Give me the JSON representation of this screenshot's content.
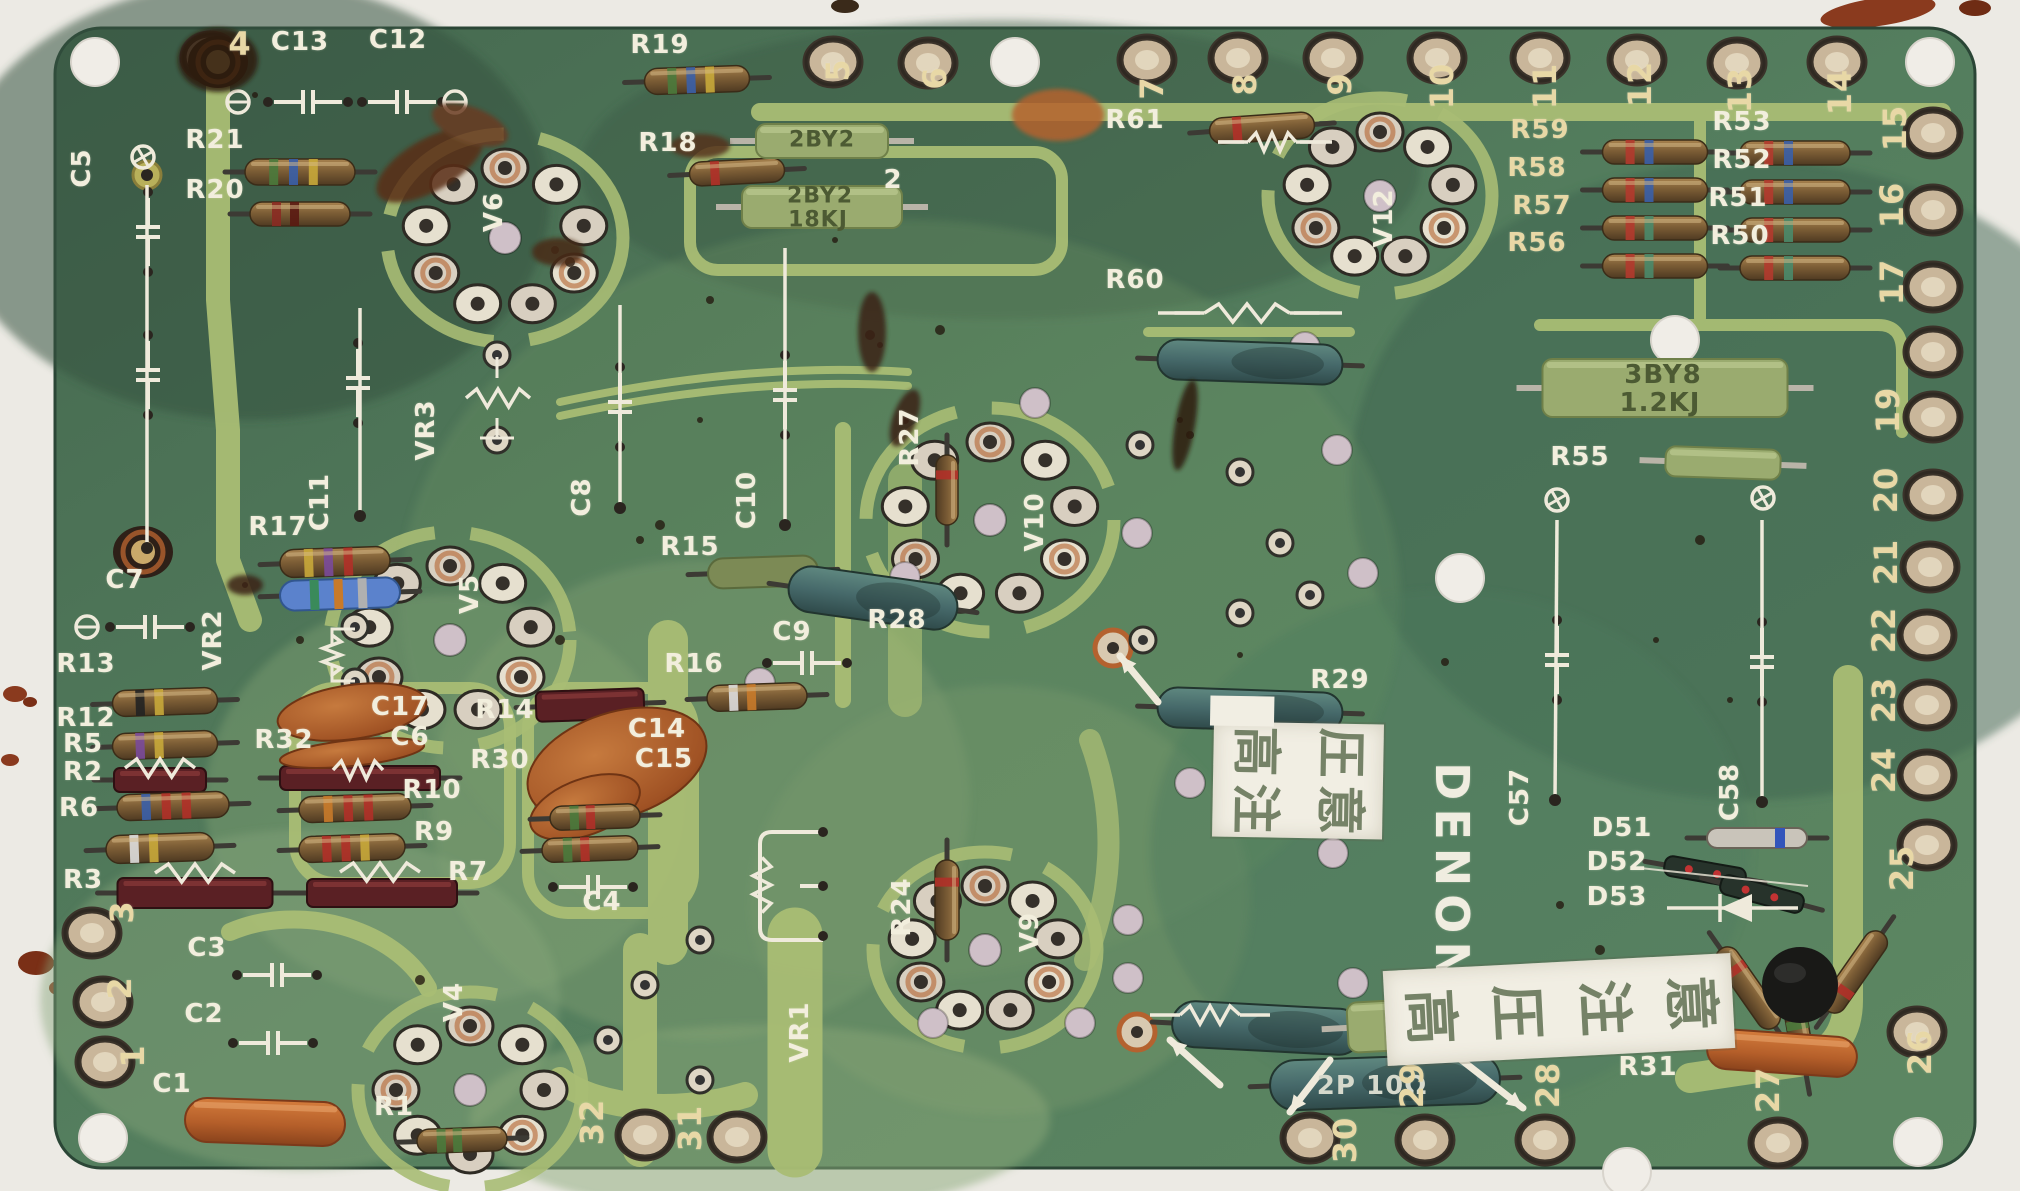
{
  "board": {
    "brand_label": "DENON"
  },
  "stickers": {
    "warning_top": "高圧注意",
    "warning_bottom": "高圧注意"
  },
  "edge_pins": {
    "top": [
      "4",
      "5",
      "6",
      "7",
      "8",
      "9",
      "10",
      "11",
      "12",
      "13",
      "14"
    ],
    "right": [
      "15",
      "16",
      "17",
      "19",
      "20",
      "21",
      "22",
      "23",
      "24",
      "25",
      "26"
    ],
    "bottom": [
      "32",
      "31",
      "30",
      "29",
      "28",
      "27"
    ],
    "left": [
      "3",
      "2",
      "1"
    ]
  },
  "labels": [
    {
      "t": "C13",
      "x": 300,
      "y": 42
    },
    {
      "t": "C12",
      "x": 398,
      "y": 40
    },
    {
      "t": "R21",
      "x": 215,
      "y": 140
    },
    {
      "t": "R20",
      "x": 215,
      "y": 190
    },
    {
      "t": "C5",
      "x": 82,
      "y": 168,
      "r": -90
    },
    {
      "t": "C7",
      "x": 125,
      "y": 580
    },
    {
      "t": "R19",
      "x": 660,
      "y": 45
    },
    {
      "t": "R18",
      "x": 668,
      "y": 143
    },
    {
      "t": "2",
      "x": 893,
      "y": 180
    },
    {
      "t": "R61",
      "x": 1135,
      "y": 120
    },
    {
      "t": "R59",
      "x": 1540,
      "y": 130,
      "c": "y"
    },
    {
      "t": "R58",
      "x": 1537,
      "y": 168,
      "c": "y"
    },
    {
      "t": "R57",
      "x": 1542,
      "y": 206,
      "c": "y"
    },
    {
      "t": "R56",
      "x": 1537,
      "y": 243,
      "c": "y"
    },
    {
      "t": "R53",
      "x": 1742,
      "y": 122
    },
    {
      "t": "R52",
      "x": 1742,
      "y": 160
    },
    {
      "t": "R51",
      "x": 1738,
      "y": 198
    },
    {
      "t": "R50",
      "x": 1740,
      "y": 236
    },
    {
      "t": "V12",
      "x": 1384,
      "y": 218,
      "r": -90
    },
    {
      "t": "R60",
      "x": 1135,
      "y": 280
    },
    {
      "t": "VR3",
      "x": 426,
      "y": 430,
      "r": -90
    },
    {
      "t": "C11",
      "x": 320,
      "y": 502,
      "r": -90
    },
    {
      "t": "R17",
      "x": 278,
      "y": 527
    },
    {
      "t": "C8",
      "x": 582,
      "y": 497,
      "r": -90
    },
    {
      "t": "C10",
      "x": 747,
      "y": 500,
      "r": -90
    },
    {
      "t": "R15",
      "x": 690,
      "y": 547
    },
    {
      "t": "V5",
      "x": 470,
      "y": 594,
      "r": -90
    },
    {
      "t": "V6",
      "x": 494,
      "y": 212,
      "r": -90
    },
    {
      "t": "VR2",
      "x": 213,
      "y": 640,
      "r": -90
    },
    {
      "t": "R27",
      "x": 910,
      "y": 437,
      "r": -90
    },
    {
      "t": "V10",
      "x": 1035,
      "y": 522,
      "r": -90
    },
    {
      "t": "R28",
      "x": 897,
      "y": 620
    },
    {
      "t": "C9",
      "x": 792,
      "y": 632
    },
    {
      "t": "R16",
      "x": 694,
      "y": 664
    },
    {
      "t": "R13",
      "x": 86,
      "y": 664
    },
    {
      "t": "R12",
      "x": 86,
      "y": 718
    },
    {
      "t": "R5",
      "x": 83,
      "y": 744
    },
    {
      "t": "R2",
      "x": 83,
      "y": 772
    },
    {
      "t": "R6",
      "x": 79,
      "y": 808
    },
    {
      "t": "R3",
      "x": 83,
      "y": 880
    },
    {
      "t": "R32",
      "x": 284,
      "y": 740
    },
    {
      "t": "C17",
      "x": 400,
      "y": 707
    },
    {
      "t": "C6",
      "x": 410,
      "y": 737
    },
    {
      "t": "R14",
      "x": 505,
      "y": 710
    },
    {
      "t": "R30",
      "x": 500,
      "y": 760
    },
    {
      "t": "R10",
      "x": 432,
      "y": 790
    },
    {
      "t": "R9",
      "x": 434,
      "y": 832
    },
    {
      "t": "R7",
      "x": 468,
      "y": 872
    },
    {
      "t": "C14",
      "x": 657,
      "y": 729
    },
    {
      "t": "C15",
      "x": 664,
      "y": 759
    },
    {
      "t": "C4",
      "x": 602,
      "y": 902
    },
    {
      "t": "C3",
      "x": 207,
      "y": 948
    },
    {
      "t": "C2",
      "x": 204,
      "y": 1014
    },
    {
      "t": "C1",
      "x": 172,
      "y": 1084
    },
    {
      "t": "R1",
      "x": 394,
      "y": 1107
    },
    {
      "t": "V4",
      "x": 454,
      "y": 1002,
      "r": -90
    },
    {
      "t": "VR1",
      "x": 800,
      "y": 1032,
      "r": -90
    },
    {
      "t": "R24",
      "x": 902,
      "y": 907,
      "r": -90
    },
    {
      "t": "V9",
      "x": 1030,
      "y": 932,
      "r": -90
    },
    {
      "t": "R29",
      "x": 1340,
      "y": 680
    },
    {
      "t": "C57",
      "x": 1520,
      "y": 797,
      "r": -90
    },
    {
      "t": "C58",
      "x": 1730,
      "y": 792,
      "r": -90
    },
    {
      "t": "D51",
      "x": 1622,
      "y": 828
    },
    {
      "t": "D52",
      "x": 1617,
      "y": 862
    },
    {
      "t": "D53",
      "x": 1617,
      "y": 897
    },
    {
      "t": "R55",
      "x": 1580,
      "y": 457
    },
    {
      "t": "R31",
      "x": 1648,
      "y": 1067
    },
    {
      "t": "2BY2",
      "x": 822,
      "y": 140,
      "s": 22,
      "c": "g"
    },
    {
      "t": "2BY2",
      "x": 820,
      "y": 196,
      "s": 22,
      "c": "g"
    },
    {
      "t": "18KJ",
      "x": 818,
      "y": 220,
      "s": 22,
      "c": "g"
    },
    {
      "t": "3BY8",
      "x": 1663,
      "y": 375,
      "s": 26,
      "c": "g"
    },
    {
      "t": "1.2KJ",
      "x": 1660,
      "y": 403,
      "s": 26,
      "c": "g"
    },
    {
      "t": "3BY2",
      "x": 1458,
      "y": 1008,
      "s": 20,
      "c": "g"
    },
    {
      "t": "39ΩJ",
      "x": 1455,
      "y": 1032,
      "s": 20,
      "c": "g"
    },
    {
      "t": "2P 10Ω",
      "x": 1372,
      "y": 1086,
      "s": 26,
      "c": "t"
    }
  ]
}
